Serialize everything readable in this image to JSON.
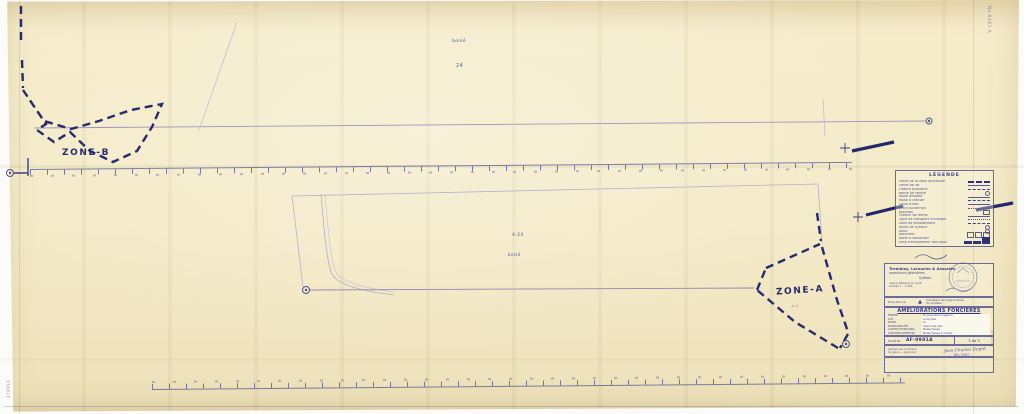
{
  "plan": {
    "zone_b_label": "ZONE-B",
    "zone_a_label": "ZONE-A",
    "zone_a_sublabel": "a-1",
    "upper_area_label": "boisé",
    "upper_lot_number": "24",
    "lower_lot_number": "4-24",
    "lower_area_label": "boisé",
    "corner_stamp_top_right": "No 8461-A",
    "corner_stamp_bottom_left": "478916",
    "margin_note": "AF-0901A"
  },
  "colors": {
    "paper": "#f4eac7",
    "ink_bold": "#262a6e",
    "ink_light": "#8f89b8",
    "handwriting": "#4a57a8"
  },
  "legend": {
    "title": "LÉGENDE",
    "items": [
      {
        "label": "limite de la zone améliorée"
      },
      {
        "label": "limite de lot"
      },
      {
        "label": "clôture existante"
      },
      {
        "label": "borne de repère"
      },
      {
        "label": "fossé existant"
      },
      {
        "label": "fossé à creuser"
      },
      {
        "label": "cours d'eau"
      },
      {
        "label": "drain souterrain"
      },
      {
        "label": "ponceau"
      },
      {
        "label": "chemin de ferme"
      },
      {
        "label": "ligne de transport d'énergie"
      },
      {
        "label": "zone de déboisement"
      },
      {
        "label": "roche de surface"
      },
      {
        "label": "puits"
      },
      {
        "label": "bâtiment"
      },
      {
        "label": "boisé à conserver"
      },
      {
        "label": "sens d'écoulement des eaux"
      }
    ]
  },
  "title_block": {
    "firm_line1": "Tremblay, Larouche & Associés",
    "firm_line2": "arpenteurs-géomètres",
    "firm_line3": "Québec",
    "note_line1": "relevé effectué en août",
    "note_line2": "échelle 1 : 1 000",
    "direction_label": "Direction du",
    "north_arrow": "▲",
    "ministry_line1": "ministère de l'Agriculture",
    "ministry_line2": "du Québec",
    "title": "AMÉLIORATIONS FONCIÈRES",
    "fields": [
      {
        "label": "FERME",
        "value": "M. Jean-Paul Gagnon"
      },
      {
        "label": "LOT",
        "value": "4-24 ptie"
      },
      {
        "label": "RANG",
        "value": "IV"
      },
      {
        "label": "MUNICIPALITÉ",
        "value": "Saint-Gervais"
      },
      {
        "label": "COMTÉ MUNICIPAL",
        "value": "Bellechasse"
      },
      {
        "label": "CIRCONSCRIPTION",
        "value": "Bellechasse (comté)"
      }
    ],
    "plan_no_label": "PLAN No",
    "plan_no_value": "AF-0901A",
    "sheet_value": "2 de 3",
    "approval_line1": "préparé par la division",
    "approval_line2": "du génie — approuvé",
    "signature": "Jean-Charles Dupré",
    "signature_date": "fév. 1987"
  }
}
